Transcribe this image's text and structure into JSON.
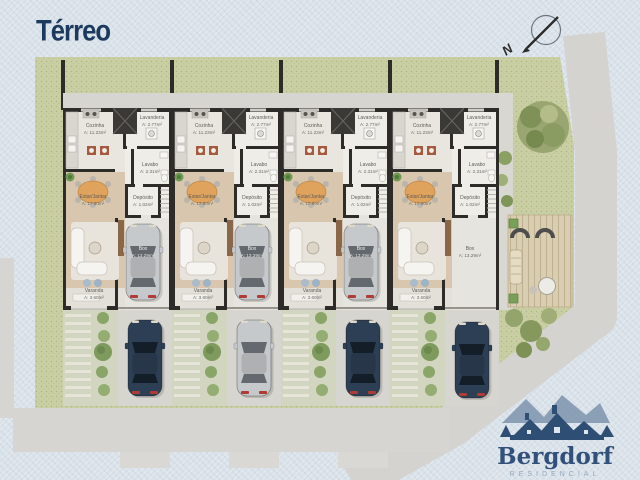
{
  "page": {
    "title": "Térreo"
  },
  "compass": {
    "label": "N"
  },
  "floor_plan": {
    "unit_count": 4,
    "rooms": [
      {
        "id": "cozinha",
        "name": "Cozinha",
        "area": "A: 11.23m²"
      },
      {
        "id": "lavanderia",
        "name": "Lavanderia",
        "area": "A: 2.77m²"
      },
      {
        "id": "lavabo",
        "name": "Lavabo",
        "area": "A: 2.31m²"
      },
      {
        "id": "estar_jantar",
        "name": "Estar/Jantar",
        "area": "A: 17.60m²"
      },
      {
        "id": "deposito",
        "name": "Depósito",
        "area": "A: 1.02m²"
      },
      {
        "id": "box",
        "name": "Box",
        "area": "A: 13.29m²"
      },
      {
        "id": "varanda",
        "name": "Varanda",
        "area": "A: 3.60m²"
      }
    ]
  },
  "site": {
    "cars": [
      {
        "spot": "garage-unit-1",
        "color_key": "silver"
      },
      {
        "spot": "garage-unit-2",
        "color_key": "silver"
      },
      {
        "spot": "garage-unit-3",
        "color_key": "silver"
      },
      {
        "spot": "driveway-unit-1",
        "color_key": "dark_blue"
      },
      {
        "spot": "driveway-unit-2",
        "color_key": "silver"
      },
      {
        "spot": "driveway-unit-3",
        "color_key": "dark_blue"
      },
      {
        "spot": "driveway-unit-4",
        "color_key": "dark_blue"
      }
    ]
  },
  "logo": {
    "name": "Bergdorf",
    "subtitle": "RESIDENCIAL"
  },
  "colors": {
    "title_navy": "#1c3a5e",
    "logo_navy": "#31507a",
    "background": "#dae2ea",
    "grass": "#c9cfa3",
    "road": "#d4d3cf",
    "sidewalk": "#d6d5d1",
    "wall": "#2e2c29",
    "living_floor": "#d8c7ae",
    "cars": {
      "silver": {
        "body": "#c6c9cb",
        "glass": "#63696e"
      },
      "dark_blue": {
        "body": "#2d3f54",
        "glass": "#131e29"
      }
    }
  }
}
